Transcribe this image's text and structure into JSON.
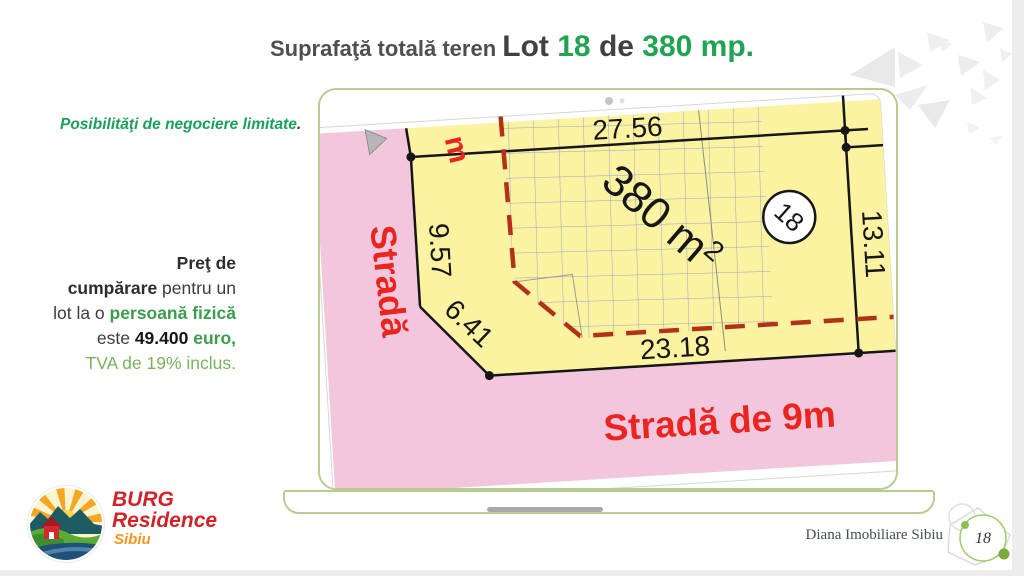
{
  "slide": {
    "title": {
      "prefix": "Suprafaţă totală teren ",
      "lot_label": "Lot ",
      "lot_number": "18",
      "connector": " de ",
      "area": "380 mp."
    },
    "note": {
      "text": "Posibilităţi de negociere limitate",
      "period": "."
    },
    "price": {
      "l1": "Preţ de",
      "l2_bold": "cumpărare",
      "l2_rest": " pentru un",
      "l3_plain": "lot la o ",
      "l3_green": "persoană fizică",
      "l4_plain": "este ",
      "l4_bold": "49.400",
      "l4_green": " euro,",
      "l5": "TVA de 19% inclus."
    }
  },
  "plan": {
    "dimensions": {
      "top": "27.56",
      "left": "9.57",
      "chamfer": "6.41",
      "bottom": "23.18",
      "right": "13.11"
    },
    "area_label": "380 m",
    "area_sup": "2",
    "lot_number": "18",
    "streets": {
      "left": "Stradă",
      "bottom": "Stradă de 9m",
      "top_partial": "m"
    }
  },
  "footer": {
    "logo": {
      "line1": "BURG",
      "line2": "Residence",
      "line3": "Sibiu"
    },
    "credit": "Diana Imobiliare Sibiu",
    "page_number": "18"
  },
  "colors": {
    "accent_green": "#21A353",
    "street_red": "#E8251F",
    "street_pink": "#F2C7DE",
    "lot_yellow": "#FBF3A1",
    "grid_blue": "#9AA1C8",
    "dash_red": "#B23119",
    "laptop_green": "#B8CC90",
    "logo_red": "#D2232A",
    "logo_orange": "#F7941D"
  }
}
